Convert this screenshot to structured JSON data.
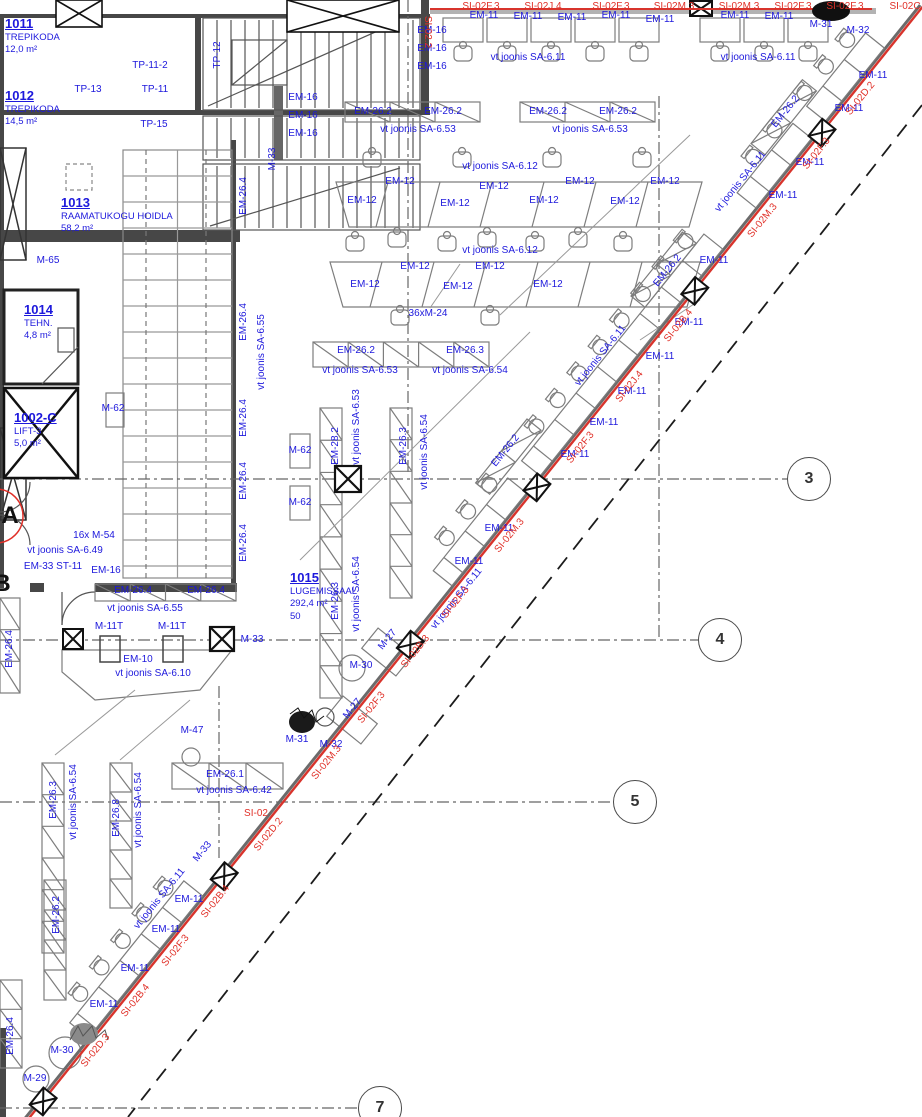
{
  "title": "Floor plan fragment - library reading room level",
  "colors": {
    "label_blue": "#1d18dc",
    "label_red": "#e03028",
    "facade_red": "#d8342c",
    "wall": "#474747"
  },
  "rooms": [
    {
      "num": "1011",
      "lines": [
        "TREPIKODA",
        "12,0 m²"
      ],
      "x": 5,
      "y": 17
    },
    {
      "num": "1012",
      "lines": [
        "TREPIKODA",
        "14,5 m²"
      ],
      "x": 5,
      "y": 89
    },
    {
      "num": "1013",
      "lines": [
        "RAAMATUKOGU HOIDLA",
        "58,2 m²"
      ],
      "x": 61,
      "y": 196
    },
    {
      "num": "1014",
      "lines": [
        "TEHN.",
        "4,8 m²"
      ],
      "x": 24,
      "y": 303
    },
    {
      "num": "1002-C",
      "lines": [
        "LIFT-3",
        "5,0 m²"
      ],
      "x": 14,
      "y": 411
    },
    {
      "num": "1015",
      "lines": [
        "LUGEMISSAAL",
        "292,4 m²",
        "50"
      ],
      "x": 290,
      "y": 571
    }
  ],
  "grid_bubbles": [
    {
      "n": "3",
      "x": 809,
      "y": 479
    },
    {
      "n": "4",
      "x": 720,
      "y": 640
    },
    {
      "n": "5",
      "x": 635,
      "y": 802
    },
    {
      "n": "7",
      "x": 380,
      "y": 1108
    }
  ],
  "grid_letters": [
    {
      "n": "A",
      "x": 10,
      "y": 516
    },
    {
      "n": "B",
      "x": 2,
      "y": 584
    }
  ],
  "labels": [
    {
      "t": "TP-11-2",
      "x": 150,
      "y": 66
    },
    {
      "t": "TP-11",
      "x": 155,
      "y": 90
    },
    {
      "t": "TP-13",
      "x": 88,
      "y": 90
    },
    {
      "t": "TP-15",
      "x": 154,
      "y": 125
    },
    {
      "t": "TP-12",
      "x": 218,
      "y": 55,
      "r": -90
    },
    {
      "t": "M-33",
      "x": 273,
      "y": 159,
      "r": -90
    },
    {
      "t": "M-65",
      "x": 48,
      "y": 261
    },
    {
      "t": "M-62",
      "x": 113,
      "y": 409
    },
    {
      "t": "M-62",
      "x": 300,
      "y": 451
    },
    {
      "t": "M-62",
      "x": 300,
      "y": 503
    },
    {
      "t": "EM-16",
      "x": 432,
      "y": 31
    },
    {
      "t": "EM-16",
      "x": 432,
      "y": 49
    },
    {
      "t": "EM-16",
      "x": 432,
      "y": 67
    },
    {
      "t": "EM-16",
      "x": 303,
      "y": 98
    },
    {
      "t": "EM-16",
      "x": 303,
      "y": 116
    },
    {
      "t": "EM-16",
      "x": 303,
      "y": 134
    },
    {
      "t": "EM-26.2",
      "x": 373,
      "y": 112
    },
    {
      "t": "EM-26.2",
      "x": 443,
      "y": 112
    },
    {
      "t": "vt joonis SA-6.53",
      "x": 418,
      "y": 130
    },
    {
      "t": "EM-26.2",
      "x": 548,
      "y": 112
    },
    {
      "t": "EM-26.2",
      "x": 618,
      "y": 112
    },
    {
      "t": "vt joonis SA-6.53",
      "x": 590,
      "y": 130
    },
    {
      "t": "EM-11",
      "x": 484,
      "y": 16
    },
    {
      "t": "EM-11",
      "x": 528,
      "y": 17
    },
    {
      "t": "EM-11",
      "x": 572,
      "y": 18
    },
    {
      "t": "EM-11",
      "x": 616,
      "y": 16
    },
    {
      "t": "EM-11",
      "x": 660,
      "y": 20
    },
    {
      "t": "EM-11",
      "x": 735,
      "y": 16
    },
    {
      "t": "EM-11",
      "x": 779,
      "y": 17
    },
    {
      "t": "M-31",
      "x": 821,
      "y": 25
    },
    {
      "t": "M-32",
      "x": 858,
      "y": 31
    },
    {
      "t": "vt joonis SA-6.11",
      "x": 528,
      "y": 58
    },
    {
      "t": "vt joonis SA-6.11",
      "x": 758,
      "y": 58
    },
    {
      "t": "SI-02F.3",
      "x": 481,
      "y": 7,
      "c": "r"
    },
    {
      "t": "SI-02J.4",
      "x": 543,
      "y": 7,
      "c": "r"
    },
    {
      "t": "SI-02F.3",
      "x": 611,
      "y": 7,
      "c": "r"
    },
    {
      "t": "SI-02M.3",
      "x": 674,
      "y": 7,
      "c": "r"
    },
    {
      "t": "SI-02M.3",
      "x": 739,
      "y": 7,
      "c": "r"
    },
    {
      "t": "SI-02F.3",
      "x": 793,
      "y": 7,
      "c": "r"
    },
    {
      "t": "SI-02F.3",
      "x": 845,
      "y": 7,
      "c": "r"
    },
    {
      "t": "SI-02C",
      "x": 905,
      "y": 7,
      "c": "r"
    },
    {
      "t": "SI-02.2",
      "x": 427,
      "y": 32,
      "r": 90,
      "c": "r"
    },
    {
      "t": "SI-02",
      "x": 256,
      "y": 814,
      "c": "r"
    },
    {
      "t": "vt joonis SA-6.12",
      "x": 500,
      "y": 167
    },
    {
      "t": "EM-12",
      "x": 400,
      "y": 182
    },
    {
      "t": "EM-12",
      "x": 494,
      "y": 187
    },
    {
      "t": "EM-12",
      "x": 580,
      "y": 182
    },
    {
      "t": "EM-12",
      "x": 665,
      "y": 182
    },
    {
      "t": "EM-12",
      "x": 362,
      "y": 201
    },
    {
      "t": "EM-12",
      "x": 455,
      "y": 204
    },
    {
      "t": "EM-12",
      "x": 544,
      "y": 201
    },
    {
      "t": "EM-12",
      "x": 625,
      "y": 202
    },
    {
      "t": "vt joonis SA-6.12",
      "x": 500,
      "y": 251
    },
    {
      "t": "EM-12",
      "x": 415,
      "y": 267
    },
    {
      "t": "EM-12",
      "x": 490,
      "y": 267
    },
    {
      "t": "EM-12",
      "x": 365,
      "y": 285
    },
    {
      "t": "EM-12",
      "x": 458,
      "y": 287
    },
    {
      "t": "EM-12",
      "x": 548,
      "y": 285
    },
    {
      "t": "36xM-24",
      "x": 428,
      "y": 314
    },
    {
      "t": "EM-26.2",
      "x": 356,
      "y": 351
    },
    {
      "t": "EM-26.3",
      "x": 465,
      "y": 351
    },
    {
      "t": "vt joonis SA-6.53",
      "x": 360,
      "y": 371
    },
    {
      "t": "vt joonis SA-6.54",
      "x": 470,
      "y": 371
    },
    {
      "t": "EM-26.4",
      "x": 244,
      "y": 196,
      "r": -90
    },
    {
      "t": "EM-26.4",
      "x": 244,
      "y": 322,
      "r": -90
    },
    {
      "t": "EM-26.4",
      "x": 244,
      "y": 418,
      "r": -90
    },
    {
      "t": "EM-26.4",
      "x": 244,
      "y": 481,
      "r": -90
    },
    {
      "t": "EM-26.4",
      "x": 244,
      "y": 543,
      "r": -90
    },
    {
      "t": "vt joonis SA-6.55",
      "x": 262,
      "y": 352,
      "r": -90
    },
    {
      "t": "EM-28.2",
      "x": 336,
      "y": 446,
      "r": -90
    },
    {
      "t": "vt joonis SA-6.53",
      "x": 357,
      "y": 427,
      "r": -90
    },
    {
      "t": "EM-26.3",
      "x": 404,
      "y": 446,
      "r": -90
    },
    {
      "t": "vt joonis SA-6.54",
      "x": 425,
      "y": 452,
      "r": -90
    },
    {
      "t": "EM-26.3",
      "x": 336,
      "y": 601,
      "r": -90
    },
    {
      "t": "vt joonis SA-6.54",
      "x": 357,
      "y": 594,
      "r": -90
    },
    {
      "t": "16x M-54",
      "x": 94,
      "y": 536
    },
    {
      "t": "vt joonis SA-6.49",
      "x": 65,
      "y": 551
    },
    {
      "t": "EM-33 ST-11",
      "x": 53,
      "y": 567
    },
    {
      "t": "EM-16",
      "x": 106,
      "y": 571
    },
    {
      "t": "EM-26.4",
      "x": 133,
      "y": 591
    },
    {
      "t": "EM-26.4",
      "x": 206,
      "y": 591
    },
    {
      "t": "vt joonis SA-6.55",
      "x": 145,
      "y": 609
    },
    {
      "t": "M-11T",
      "x": 109,
      "y": 627
    },
    {
      "t": "M-11T",
      "x": 172,
      "y": 627
    },
    {
      "t": "M-33",
      "x": 252,
      "y": 640
    },
    {
      "t": "EM-10",
      "x": 138,
      "y": 660
    },
    {
      "t": "vt joonis SA-6.10",
      "x": 153,
      "y": 674
    },
    {
      "t": "EM-26.4",
      "x": 10,
      "y": 649,
      "r": -90
    },
    {
      "t": "M-47",
      "x": 192,
      "y": 731
    },
    {
      "t": "EM-26.1",
      "x": 225,
      "y": 775
    },
    {
      "t": "vt joonis SA-6.42",
      "x": 234,
      "y": 791
    },
    {
      "t": "EM-26.3",
      "x": 54,
      "y": 800,
      "r": -90
    },
    {
      "t": "vt joonis SA-6.54",
      "x": 74,
      "y": 802,
      "r": -90
    },
    {
      "t": "EM-26.8",
      "x": 117,
      "y": 818,
      "r": -90
    },
    {
      "t": "vt joonis SA-6.54",
      "x": 139,
      "y": 810,
      "r": -90
    },
    {
      "t": "EM-26.2",
      "x": 57,
      "y": 915,
      "r": -90
    },
    {
      "t": "EM-26.4",
      "x": 11,
      "y": 1036,
      "r": -90
    },
    {
      "t": "M-27",
      "x": 388,
      "y": 640,
      "r": -51
    },
    {
      "t": "M-27",
      "x": 353,
      "y": 709,
      "r": -51
    },
    {
      "t": "M-30",
      "x": 361,
      "y": 666
    },
    {
      "t": "M-31",
      "x": 297,
      "y": 740
    },
    {
      "t": "M-32",
      "x": 331,
      "y": 745
    },
    {
      "t": "M-33",
      "x": 203,
      "y": 852,
      "r": -51
    },
    {
      "t": "M-30",
      "x": 62,
      "y": 1051
    },
    {
      "t": "M-29",
      "x": 35,
      "y": 1079
    },
    {
      "t": "EM-11",
      "x": 873,
      "y": 76
    },
    {
      "t": "EM-11",
      "x": 849,
      "y": 109
    },
    {
      "t": "EM-11",
      "x": 810,
      "y": 163
    },
    {
      "t": "EM-11",
      "x": 783,
      "y": 196
    },
    {
      "t": "EM-11",
      "x": 714,
      "y": 261
    },
    {
      "t": "EM-11",
      "x": 689,
      "y": 323
    },
    {
      "t": "EM-11",
      "x": 660,
      "y": 357
    },
    {
      "t": "EM-11",
      "x": 632,
      "y": 392
    },
    {
      "t": "EM-11",
      "x": 604,
      "y": 423
    },
    {
      "t": "EM-11",
      "x": 575,
      "y": 455
    },
    {
      "t": "EM-11",
      "x": 499,
      "y": 529
    },
    {
      "t": "EM-11",
      "x": 469,
      "y": 562
    },
    {
      "t": "EM-11",
      "x": 189,
      "y": 900
    },
    {
      "t": "EM-11",
      "x": 166,
      "y": 930
    },
    {
      "t": "EM-11",
      "x": 135,
      "y": 969
    },
    {
      "t": "EM-11",
      "x": 104,
      "y": 1005
    },
    {
      "t": "EM-26.2",
      "x": 786,
      "y": 112,
      "r": -51
    },
    {
      "t": "EM-26.2",
      "x": 668,
      "y": 271,
      "r": -51
    },
    {
      "t": "EM-26.2",
      "x": 506,
      "y": 451,
      "r": -51
    },
    {
      "t": "vt joonis SA-6.11",
      "x": 741,
      "y": 182,
      "r": -51
    },
    {
      "t": "vt joonis SA-6.11",
      "x": 601,
      "y": 356,
      "r": -51
    },
    {
      "t": "vt joonis SA-6.11",
      "x": 457,
      "y": 599,
      "r": -51
    },
    {
      "t": "vt joonis SA-6.11",
      "x": 160,
      "y": 899,
      "r": -51
    },
    {
      "t": "SI-02D.2",
      "x": 861,
      "y": 99,
      "r": -51,
      "c": "r"
    },
    {
      "t": "SI-02F.3",
      "x": 817,
      "y": 154,
      "r": -51,
      "c": "r"
    },
    {
      "t": "SI-02M.3",
      "x": 763,
      "y": 221,
      "r": -51,
      "c": "r"
    },
    {
      "t": "SI-02B.4",
      "x": 679,
      "y": 326,
      "r": -51,
      "c": "r"
    },
    {
      "t": "SI-02J.4",
      "x": 630,
      "y": 387,
      "r": -51,
      "c": "r"
    },
    {
      "t": "SI-02F.3",
      "x": 581,
      "y": 448,
      "r": -51,
      "c": "r"
    },
    {
      "t": "SI-02M.3",
      "x": 510,
      "y": 536,
      "r": -51,
      "c": "r"
    },
    {
      "t": "SI-02F.3",
      "x": 456,
      "y": 603,
      "r": -51,
      "c": "r"
    },
    {
      "t": "SI-02B.3",
      "x": 416,
      "y": 652,
      "r": -51,
      "c": "r"
    },
    {
      "t": "SI-02F.3",
      "x": 372,
      "y": 708,
      "r": -51,
      "c": "r"
    },
    {
      "t": "SI-02M.3",
      "x": 327,
      "y": 763,
      "r": -51,
      "c": "r"
    },
    {
      "t": "SI-02D.2",
      "x": 269,
      "y": 835,
      "r": -51,
      "c": "r"
    },
    {
      "t": "SI-02B.4",
      "x": 216,
      "y": 902,
      "r": -51,
      "c": "r"
    },
    {
      "t": "SI-02F.3",
      "x": 176,
      "y": 951,
      "r": -51,
      "c": "r"
    },
    {
      "t": "SI-02B.4",
      "x": 136,
      "y": 1001,
      "r": -51,
      "c": "r"
    },
    {
      "t": "SI-02D.3",
      "x": 96,
      "y": 1051,
      "r": -51,
      "c": "r"
    }
  ]
}
